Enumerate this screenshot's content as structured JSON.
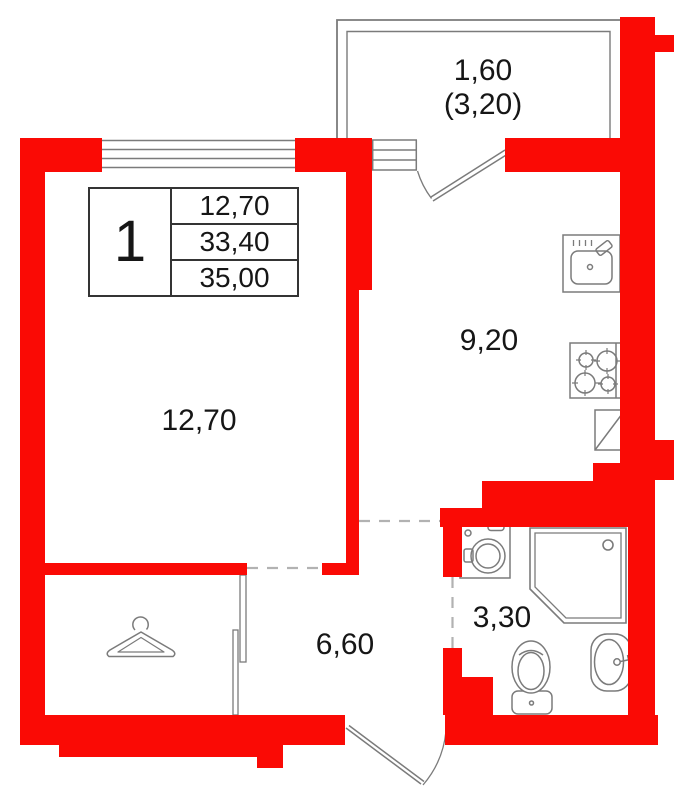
{
  "title": "Apartment 1 floor plan",
  "colors": {
    "wall_red": "#fa0a05",
    "line_gray": "#7b7b7b",
    "dash_gray": "#b2b2b2",
    "text_black": "#161616"
  },
  "info_table": {
    "apartment_number": "1",
    "living_area": "12,70",
    "total_area": "33,40",
    "total_area_with_balcony": "35,00"
  },
  "room_labels": {
    "living": "12,70",
    "kitchen": "9,20",
    "hallway": "6,60",
    "bathroom": "3,30",
    "balcony": "1,60",
    "balcony_with_coefficient": "(3,20)"
  },
  "fixture_icons": [
    "kitchen-sink-icon",
    "stove-icon",
    "kitchen-cabinet-icon",
    "washing-machine-icon",
    "shower-cabin-icon",
    "toilet-icon",
    "bathroom-sink-icon",
    "clothes-hanger-icon"
  ],
  "opening_symbols": [
    "living-room-window",
    "balcony-door-window",
    "balcony-door",
    "entrance-door",
    "balcony-outline",
    "closet-sliding-partition"
  ]
}
